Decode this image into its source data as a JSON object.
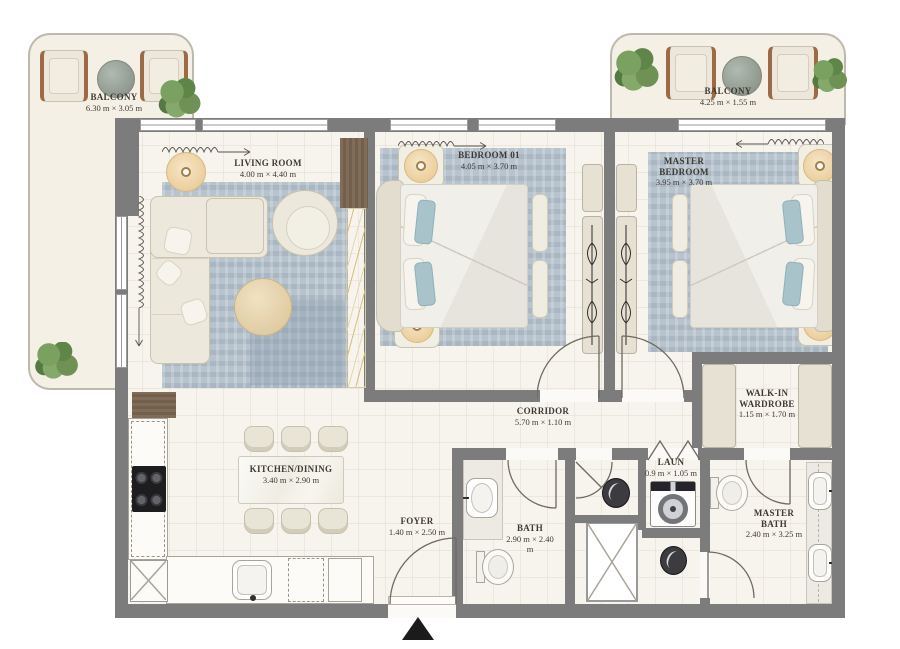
{
  "balconies": [
    {
      "name": "BALCONY",
      "dims": "6.30 m × 3.05 m"
    },
    {
      "name": "BALCONY",
      "dims": "4.25 m × 1.55 m"
    }
  ],
  "rooms": {
    "living": {
      "name": "LIVING ROOM",
      "dims": "4.00 m × 4.40 m"
    },
    "bedroom1": {
      "name": "BEDROOM 01",
      "dims": "4.05 m × 3.70 m"
    },
    "master_bedroom": {
      "name": "MASTER BEDROOM",
      "dims": "3.95 m × 3.70 m"
    },
    "corridor": {
      "name": "CORRIDOR",
      "dims": "5.70 m × 1.10 m"
    },
    "kitchen": {
      "name": "KITCHEN/DINING",
      "dims": "3.40 m × 2.90 m"
    },
    "foyer": {
      "name": "FOYER",
      "dims": "1.40 m × 2.50 m"
    },
    "bath": {
      "name": "BATH",
      "dims": "2.90 m × 2.40 m"
    },
    "laundry": {
      "name": "LAUN",
      "dims": "0.9 m × 1.05 m"
    },
    "walkin": {
      "name": "WALK-IN WARDROBE",
      "dims": "1.15 m × 1.70 m"
    },
    "master_bath": {
      "name": "MASTER BATH",
      "dims": "2.40 m × 3.25 m"
    }
  },
  "colors": {
    "wall": "#7c7c7c",
    "floor": "#f7f4ed",
    "balcony_floor": "#f4f0e6",
    "rug": "#b7c3cd",
    "wood": "#77624e",
    "marble_vein": "#d9bc7a",
    "plant": "#6f9155",
    "lamp": "#f2ddb6",
    "furniture": "#ece8db",
    "entry_marker": "#1b1b1b"
  },
  "icons": {
    "entrance-marker-icon": "solid up triangle",
    "door-swing-icon": "quarter-circle arc",
    "curtain-icon": "wavy line with arrow",
    "plant-icon": "green foliage cluster",
    "lamp-icon": "round bedside lamp",
    "hanger-rail-icon": "wardrobe rail glyph",
    "shaft-x-icon": "crossed box",
    "cooktop-icon": "four burner hob",
    "washer-icon": "washing machine",
    "toilet-icon": "toilet top view",
    "basin-icon": "wash basin",
    "sink-icon": "kitchen sink"
  }
}
